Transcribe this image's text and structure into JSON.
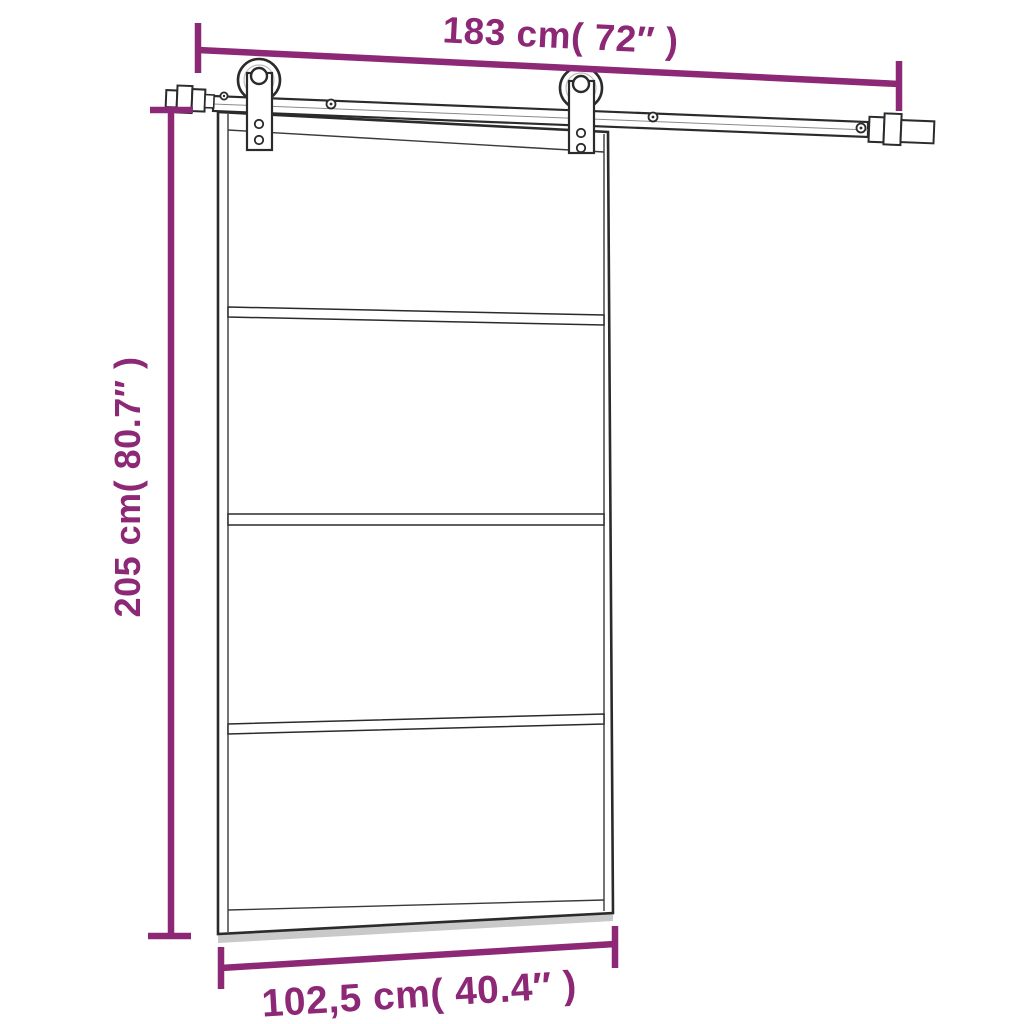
{
  "page": {
    "type": "product-dimension-diagram",
    "subject": "sliding-door-with-rail-hardware",
    "background": "#FFFFFF"
  },
  "colors": {
    "dimension_accent": "#8C2876",
    "line_art": "#2B2B2B",
    "shadow_gray": "#C9C9C9"
  },
  "dimensions": {
    "rail_width": {
      "label": "183 cm( 72″ )",
      "orientation": "top"
    },
    "door_height": {
      "label": "205 cm( 80.7″ )",
      "orientation": "left"
    },
    "door_width": {
      "label": "102,5 cm( 40.4″ )",
      "orientation": "bottom"
    }
  },
  "door": {
    "panel_count": 4,
    "divider_count": 3,
    "roller_count": 2,
    "rail_screw_count": 4
  }
}
